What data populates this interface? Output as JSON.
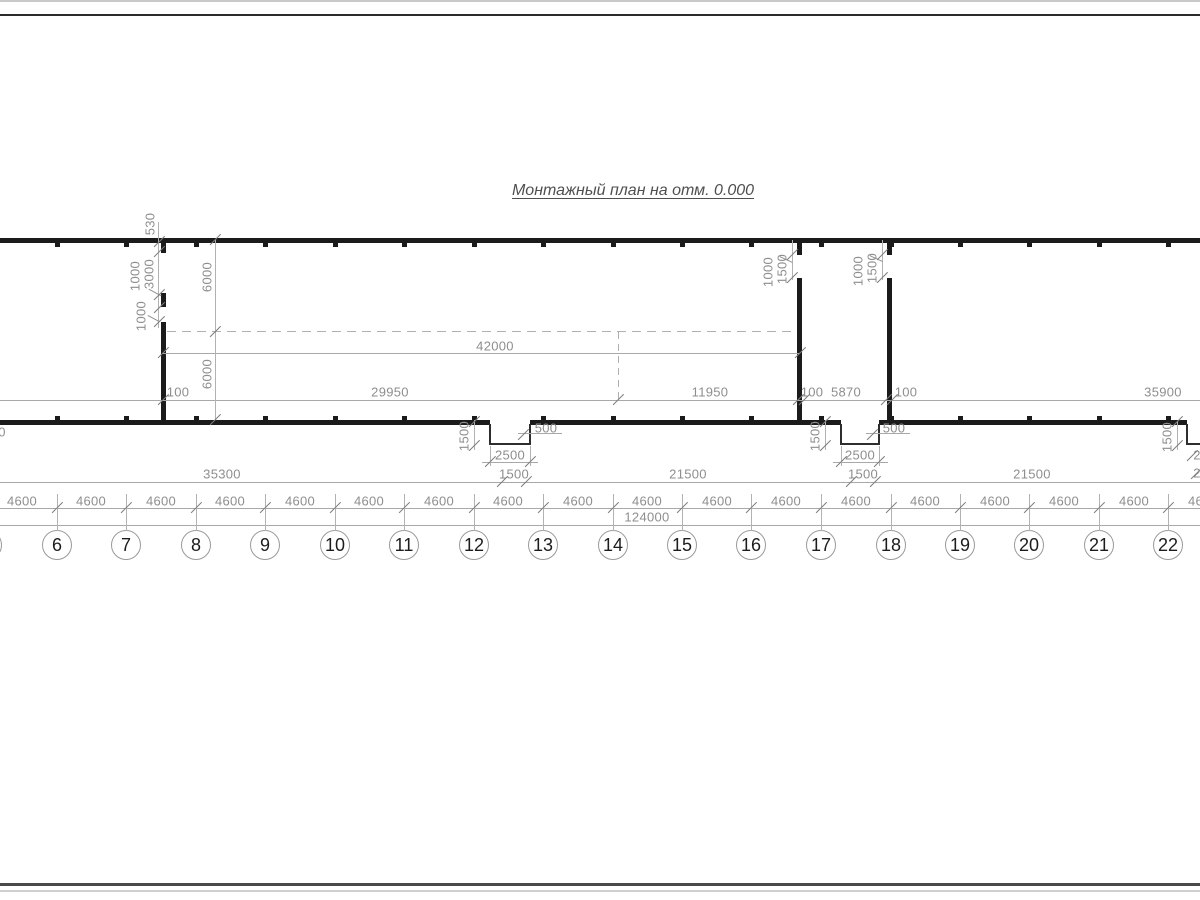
{
  "title": "Монтажный план на отм. 0.000",
  "axes": {
    "labels": [
      "6",
      "7",
      "8",
      "9",
      "10",
      "11",
      "12",
      "13",
      "14",
      "15",
      "16",
      "17",
      "18",
      "19",
      "20",
      "21",
      "22"
    ],
    "x": [
      57,
      126,
      196,
      265,
      335,
      404,
      474,
      543,
      613,
      682,
      751,
      821,
      891,
      960,
      1029,
      1099,
      1168
    ],
    "circle_y": 545,
    "partial_left_x": -13
  },
  "spacing": {
    "label": "4600",
    "centers": [
      22,
      91,
      161,
      230,
      300,
      369,
      439,
      508,
      578,
      647,
      717,
      786,
      856,
      925,
      995,
      1064,
      1134,
      1203
    ],
    "y": 501
  },
  "dim_labels": [
    {
      "text": "530",
      "x": 150,
      "y": 224,
      "v": 1
    },
    {
      "text": "1000",
      "x": 135,
      "y": 276,
      "v": 1
    },
    {
      "text": "3000",
      "x": 149,
      "y": 274,
      "v": 1
    },
    {
      "text": "1000",
      "x": 141,
      "y": 316,
      "v": 1
    },
    {
      "text": "6000",
      "x": 207,
      "y": 277,
      "v": 1
    },
    {
      "text": "6000",
      "x": 207,
      "y": 374,
      "v": 1
    },
    {
      "text": "42000",
      "x": 495,
      "y": 346
    },
    {
      "text": "100",
      "x": 178,
      "y": 392
    },
    {
      "text": "29950",
      "x": 390,
      "y": 392
    },
    {
      "text": "11950",
      "x": 710,
      "y": 392
    },
    {
      "text": "100",
      "x": 812,
      "y": 392
    },
    {
      "text": "5870",
      "x": 846,
      "y": 392
    },
    {
      "text": "100",
      "x": 906,
      "y": 392
    },
    {
      "text": "35900",
      "x": 1163,
      "y": 392
    },
    {
      "text": "1000",
      "x": 768,
      "y": 272,
      "v": 1
    },
    {
      "text": "1500",
      "x": 782,
      "y": 269,
      "v": 1
    },
    {
      "text": "1000",
      "x": 858,
      "y": 271,
      "v": 1
    },
    {
      "text": "1500",
      "x": 872,
      "y": 268,
      "v": 1
    },
    {
      "text": "1500",
      "x": 464,
      "y": 436,
      "v": 1
    },
    {
      "text": "500",
      "x": 546,
      "y": 428
    },
    {
      "text": "2500",
      "x": 510,
      "y": 455
    },
    {
      "text": "1500",
      "x": 514,
      "y": 474
    },
    {
      "text": "1500",
      "x": 815,
      "y": 436,
      "v": 1
    },
    {
      "text": "500",
      "x": 894,
      "y": 428
    },
    {
      "text": "2500",
      "x": 860,
      "y": 455
    },
    {
      "text": "1500",
      "x": 863,
      "y": 474
    },
    {
      "text": "1500",
      "x": 1167,
      "y": 437,
      "v": 1
    },
    {
      "text": "2",
      "x": 1197,
      "y": 455
    },
    {
      "text": "35300",
      "x": 222,
      "y": 474
    },
    {
      "text": "21500",
      "x": 688,
      "y": 474
    },
    {
      "text": "21500",
      "x": 1032,
      "y": 474
    },
    {
      "text": "2",
      "x": 1197,
      "y": 473
    },
    {
      "text": "124000",
      "x": 647,
      "y": 517
    },
    {
      "text": "0",
      "x": 2,
      "y": 432
    }
  ],
  "ticks": [
    [
      163,
      400
    ],
    [
      618,
      400
    ],
    [
      798,
      400
    ],
    [
      804,
      400
    ],
    [
      886,
      400
    ],
    [
      892,
      400
    ],
    [
      163,
      353
    ],
    [
      800,
      353
    ],
    [
      215,
      240
    ],
    [
      215,
      332
    ],
    [
      215,
      420
    ],
    [
      159,
      242
    ],
    [
      159,
      252
    ],
    [
      159,
      295
    ],
    [
      159,
      308
    ],
    [
      159,
      322
    ],
    [
      792,
      255
    ],
    [
      792,
      278
    ],
    [
      882,
      255
    ],
    [
      882,
      278
    ],
    [
      474,
      422
    ],
    [
      474,
      446
    ],
    [
      523,
      435
    ],
    [
      490,
      462
    ],
    [
      530,
      462
    ],
    [
      502,
      482
    ],
    [
      526,
      482
    ],
    [
      825,
      422
    ],
    [
      825,
      446
    ],
    [
      872,
      435
    ],
    [
      841,
      462
    ],
    [
      879,
      462
    ],
    [
      851,
      482
    ],
    [
      875,
      482
    ],
    [
      1177,
      422
    ],
    [
      1177,
      446
    ],
    [
      1192,
      456
    ],
    [
      1196,
      474
    ]
  ]
}
